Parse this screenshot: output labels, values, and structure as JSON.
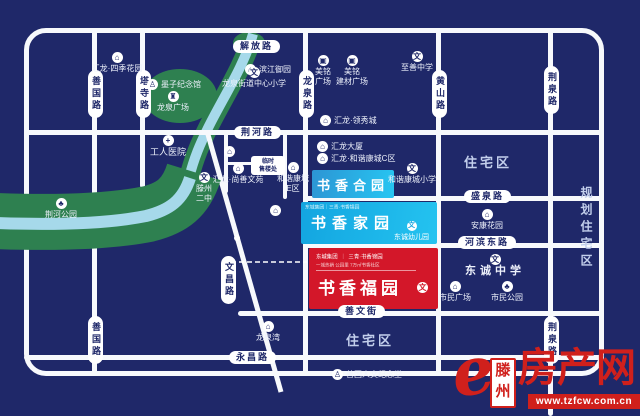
{
  "colors": {
    "background": "#1F2869",
    "road": "#F7F9FC",
    "park_green": "#2E8050",
    "river_blue": "#A6D9EA",
    "estate_cyan": "#1FB4E8",
    "estate_red": "#D31729",
    "brand_red": "#D0201C"
  },
  "road_labels": {
    "jiefang": "解放路",
    "jinghe": "荆河路",
    "shengquan": "盛泉路",
    "hebindong": "河滨东路",
    "shanwenjie": "善文街",
    "yongchang": "永昌路",
    "shanguo": "善国路",
    "tasi": "塔寺路",
    "longquan": "龙泉路",
    "huangshan": "黄山路",
    "jingquan": "荆泉路",
    "wenchang": "文昌路"
  },
  "areas": {
    "residential": "住宅区",
    "planned_residential": "规划住宅区",
    "jinghe_park": "荆河公园"
  },
  "estates": {
    "heyuan": {
      "name": "书香合园"
    },
    "jiayuan": {
      "name": "书香家园",
      "header": "东城集团｜三青·书香锦园",
      "kindergarten": "东诚幼儿园",
      "icon": "文"
    },
    "fuyuan": {
      "name": "书香福园",
      "logo_left": "东城集团",
      "logo_sep": "｜",
      "logo_right": "三青·书香锦园",
      "tagline": "一城热销 公园里 7万㎡书香社区",
      "icon": "文"
    }
  },
  "sales_office": {
    "label": "临时\n售楼处"
  },
  "icon_glyphs": {
    "building": "⌂",
    "school": "文",
    "mall": "▣",
    "hospital": "+",
    "tree": "♣",
    "monument": "♙",
    "tower": "♜"
  },
  "pois": [
    {
      "label": "汇龙·四季花园",
      "icon": "building"
    },
    {
      "label": "滨江御园",
      "icon": "building"
    },
    {
      "label": "美铭\n广场",
      "icon": "mall"
    },
    {
      "label": "美铭\n建材广场",
      "icon": "mall"
    },
    {
      "label": "至善中学",
      "icon": "school"
    },
    {
      "label": "龙泉街道中心小学",
      "icon": "school"
    },
    {
      "label": "墨子纪念馆",
      "icon": "monument"
    },
    {
      "label": "龙泉广场",
      "icon": "tower"
    },
    {
      "label": "工人医院",
      "icon": "hospital"
    },
    {
      "label": "汇龙·领秀城",
      "icon": "building"
    },
    {
      "label": "汇龙大厦",
      "icon": "building"
    },
    {
      "label": "汇龙·和谐康城C区",
      "icon": "building"
    },
    {
      "label": "汇龙·尚善文苑",
      "icon": "building"
    },
    {
      "label": "和谐康城\nE区",
      "icon": "building"
    },
    {
      "label": "滕州\n二中",
      "icon": "school"
    },
    {
      "label": "和谐康城小学",
      "icon": "school"
    },
    {
      "label": "安康花园",
      "icon": "building"
    },
    {
      "label": "东诚中学",
      "icon": "school"
    },
    {
      "label": "市民广场",
      "icon": "building"
    },
    {
      "label": "市民公园",
      "icon": "tree"
    },
    {
      "label": "龙泉湾",
      "icon": "building"
    },
    {
      "label": "善国人文纪念堂",
      "icon": "monument"
    },
    {
      "label": "荆河公园",
      "icon": "tree"
    }
  ],
  "watermark": {
    "city": "滕州",
    "site": "房产网",
    "url": "www.tzfcw.com.cn",
    "logo_letter": "e"
  }
}
